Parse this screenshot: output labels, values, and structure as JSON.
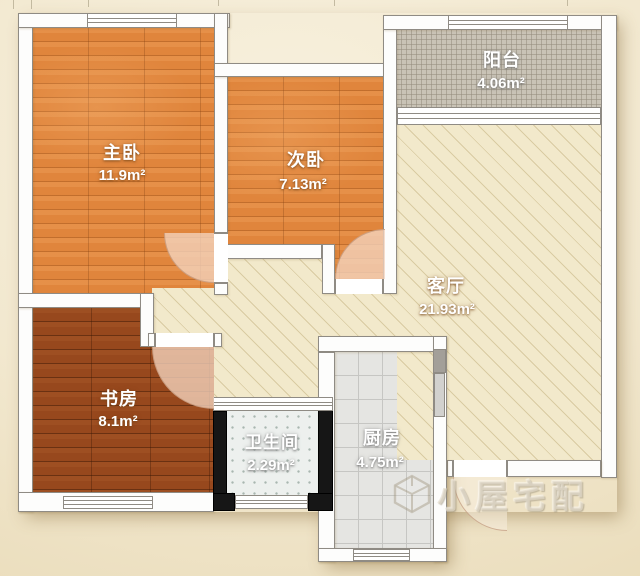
{
  "plan": {
    "type": "apartment-floor-plan",
    "rooms": [
      {
        "id": "master-bedroom",
        "name": "主卧",
        "area": "11.9m²"
      },
      {
        "id": "second-bedroom",
        "name": "次卧",
        "area": "7.13m²"
      },
      {
        "id": "balcony",
        "name": "阳台",
        "area": "4.06m²"
      },
      {
        "id": "living-room",
        "name": "客厅",
        "area": "21.93m²"
      },
      {
        "id": "study",
        "name": "书房",
        "area": "8.1m²"
      },
      {
        "id": "bathroom",
        "name": "卫生间",
        "area": "2.29m²"
      },
      {
        "id": "kitchen",
        "name": "厨房",
        "area": "4.75m²"
      }
    ]
  },
  "watermark": {
    "text": "小屋宅配",
    "logo": "cube-house-logo"
  },
  "palette": {
    "wood_light": "#e0853c",
    "wood_dark": "#97481d",
    "hatch_floor": "#f2e9cb",
    "balcony_tile": "#c9c3b6",
    "bathroom_tile": "#edf0ee",
    "kitchen_tile": "#e5e5e2",
    "wall_white": "#fdfdfc",
    "wall_black": "#161616",
    "background": "#f1e7cc",
    "door_arc": "#f4d3be"
  }
}
